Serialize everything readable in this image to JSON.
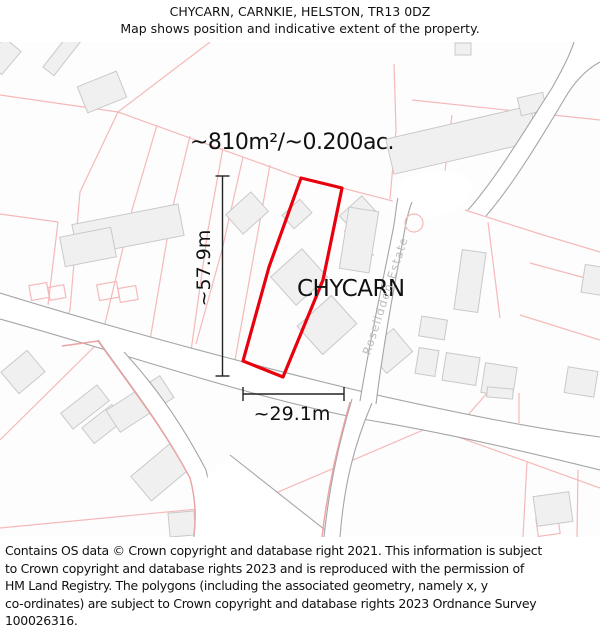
{
  "header": {
    "title": "CHYCARN, CARNKIE, HELSTON, TR13 0DZ",
    "subtitle": "Map shows position and indicative extent of the property."
  },
  "map": {
    "area_label": "~810m²/~0.200ac.",
    "property_label": "CHYCARN",
    "street_label": "Roselidden Estate",
    "dimensions": {
      "height_label": "~57.9m",
      "width_label": "~29.1m"
    },
    "colors": {
      "plot_outline": "#e8000d",
      "parcel_line": "#f5b9b9",
      "parcel_line_strong": "#eda3a3",
      "building_fill": "#f0f0f0",
      "building_stroke": "#c9c9c9",
      "road_casing": "#a5a5a5",
      "road_fill": "#ffffff",
      "street_label_color": "#bdbdbd",
      "background": "#fdfdfd"
    }
  },
  "footer": {
    "lines": [
      "Contains OS data © Crown copyright and database right 2021. This information is subject",
      "to Crown copyright and database rights 2023 and is reproduced with the permission of",
      "HM Land Registry. The polygons (including the associated geometry, namely x, y",
      "co-ordinates) are subject to Crown copyright and database rights 2023 Ordnance Survey",
      "100026316."
    ]
  }
}
